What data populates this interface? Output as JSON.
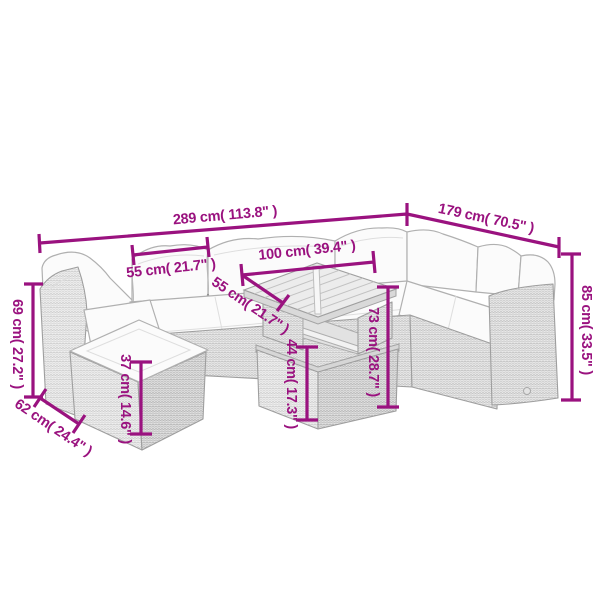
{
  "figure": {
    "description": "Dimension diagram of a grey poly-rattan garden lounge set: L-shaped sofa with white cushions, footstool ottoman and slatted-top table",
    "style": {
      "accent_color": "#9A127F",
      "outline_color": "#9e9e9e",
      "cushion_color": "#fbfbfb",
      "background_color": "#ffffff"
    },
    "dimensions": [
      {
        "name": "sofa-total-width",
        "label": "289 cm( 113.8\" )",
        "cm": 289,
        "inch": 113.8
      },
      {
        "name": "sofa-total-depth",
        "label": "179 cm( 70.5\" )",
        "cm": 179,
        "inch": 70.5
      },
      {
        "name": "seat-section-width",
        "label": "55 cm( 21.7\" )",
        "cm": 55,
        "inch": 21.7
      },
      {
        "name": "table-length",
        "label": "100 cm( 39.4\" )",
        "cm": 100,
        "inch": 39.4
      },
      {
        "name": "table-depth",
        "label": "55 cm( 21.7\" )",
        "cm": 55,
        "inch": 21.7
      },
      {
        "name": "table-height",
        "label": "73 cm( 28.7\" )",
        "cm": 73,
        "inch": 28.7
      },
      {
        "name": "table-base-height",
        "label": "44 cm( 17.3\" )",
        "cm": 44,
        "inch": 17.3
      },
      {
        "name": "backrest-height",
        "label": "85 cm( 33.5\" )",
        "cm": 85,
        "inch": 33.5
      },
      {
        "name": "left-backrest-height",
        "label": "69 cm( 27.2\" )",
        "cm": 69,
        "inch": 27.2
      },
      {
        "name": "ottoman-depth",
        "label": "62 cm( 24.4\" )",
        "cm": 62,
        "inch": 24.4
      },
      {
        "name": "ottoman-height",
        "label": "37 cm( 14.6\" )",
        "cm": 37,
        "inch": 14.6
      }
    ]
  }
}
